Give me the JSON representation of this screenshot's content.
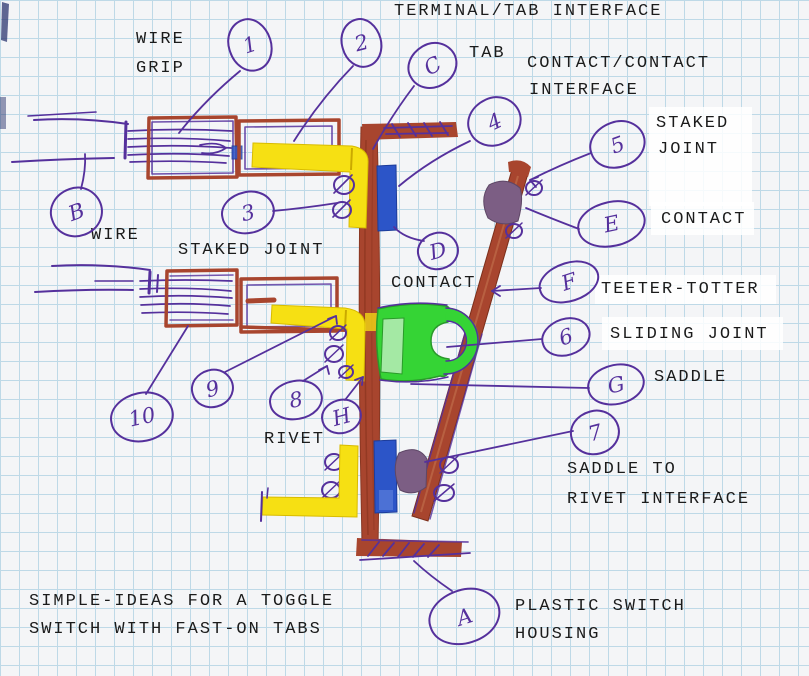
{
  "sketch_title": {
    "line1": "SIMPLE-IDEAS FOR A TOGGLE",
    "line2": "SWITCH WITH FAST-ON TABS"
  },
  "labels": {
    "terminal_tab_interface": "TERMINAL/TAB INTERFACE",
    "wire_grip_l1": "WIRE",
    "wire_grip_l2": "GRIP",
    "tab": "TAB",
    "contact_contact_l1": "CONTACT/CONTACT",
    "contact_contact_l2": "INTERFACE",
    "staked_joint_right_l1": "STAKED",
    "staked_joint_right_l2": "JOINT",
    "contact_right": "CONTACT",
    "wire_left": "WIRE",
    "staked_joint_left": "STAKED JOINT",
    "contact_mid": "CONTACT",
    "teeter_totter": "TEETER-TOTTER",
    "sliding_joint": "SLIDING JOINT",
    "saddle": "SADDLE",
    "rivet": "RIVET",
    "saddle_to_rivet_l1": "SADDLE TO",
    "saddle_to_rivet_l2": "RIVET INTERFACE",
    "plastic_housing_l1": "PLASTIC SWITCH",
    "plastic_housing_l2": "HOUSING"
  },
  "callouts": {
    "n1": "1",
    "n2": "2",
    "C": "C",
    "n4": "4",
    "n5": "5",
    "E": "E",
    "B": "B",
    "n3": "3",
    "D": "D",
    "F": "F",
    "n6": "6",
    "G": "G",
    "n10": "10",
    "n9": "9",
    "n8": "8",
    "H": "H",
    "n7": "7",
    "A": "A"
  },
  "colors": {
    "ink_purple": "#55309c",
    "marker_brown": "#a8452e",
    "tab_yellow": "#f6e013",
    "contact_blue": "#2c55c8",
    "saddle_green": "#35d435",
    "saddle_green_light": "#a4e9a4",
    "rivet_gray_purple": "#7c5e84",
    "grid_blue": "#bed9e7",
    "paper": "#f4f5f7",
    "text_black": "#1b1b1b"
  }
}
